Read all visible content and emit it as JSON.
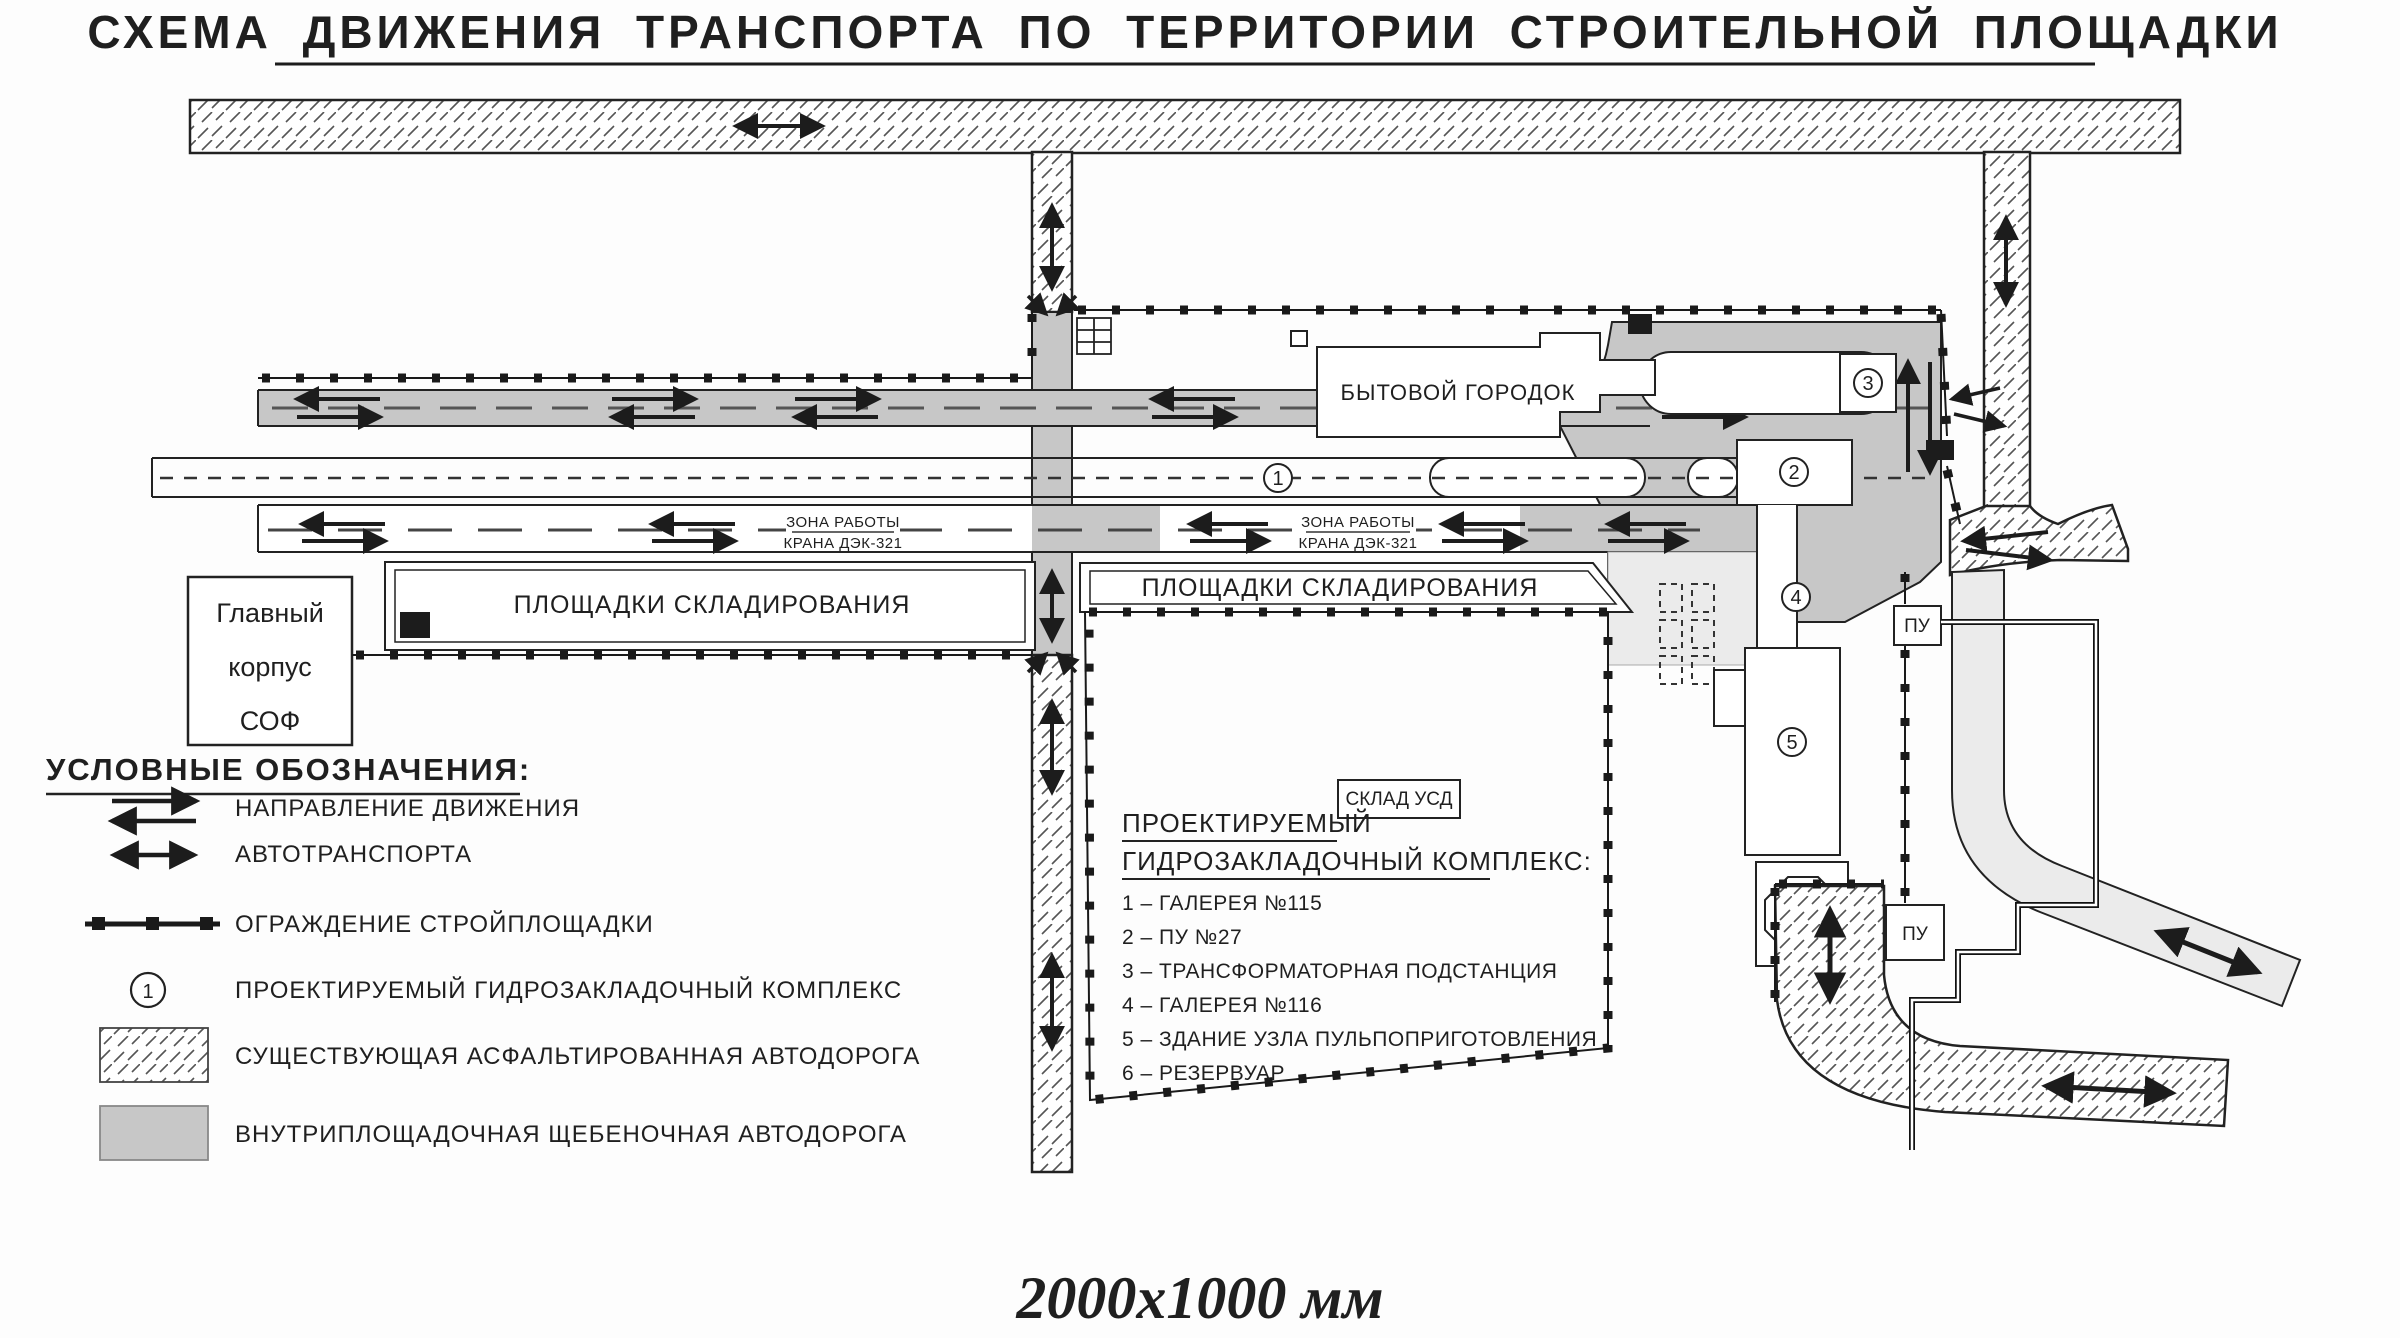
{
  "title": "СХЕМА ДВИЖЕНИЯ ТРАНСПОРТА ПО ТЕРРИТОРИИ СТРОИТЕЛЬНОЙ ПЛОЩАДКИ",
  "footer_size": "2000x1000 мм",
  "plan": {
    "main_building": {
      "line1": "Главный",
      "line2": "корпус",
      "line3": "СОФ"
    },
    "camp_label": "БЫТОВОЙ ГОРОДОК",
    "storage_area_1": "ПЛОЩАДКИ СКЛАДИРОВАНИЯ",
    "storage_area_2": "ПЛОЩАДКИ СКЛАДИРОВАНИЯ",
    "crane_zone": {
      "line1": "ЗОНА РАБОТЫ",
      "line2": "КРАНА ДЭК-321"
    },
    "usd_warehouse": "СКЛАД УСД",
    "pu_label_1": "ПУ",
    "pu_label_2": "ПУ",
    "markers": {
      "1": "1",
      "2": "2",
      "3": "3",
      "4": "4",
      "5": "5",
      "6": "6"
    }
  },
  "complex_list": {
    "heading_line1": "ПРОЕКТИРУЕМЫЙ",
    "heading_line2": "ГИДРОЗАКЛАДОЧНЫЙ КОМПЛЕКС:",
    "items": [
      "1 – ГАЛЕРЕЯ №115",
      "2 – ПУ №27",
      "3 – ТРАНСФОРМАТОРНАЯ ПОДСТАНЦИЯ",
      "4 – ГАЛЕРЕЯ №116",
      "5 – ЗДАНИЕ УЗЛА ПУЛЬПОПРИГОТОВЛЕНИЯ",
      "6 – РЕЗЕРВУАР"
    ]
  },
  "legend": {
    "heading": "УСЛОВНЫЕ ОБОЗНАЧЕНИЯ:",
    "direction_line1": "НАПРАВЛЕНИЕ ДВИЖЕНИЯ",
    "direction_line2": "АВТОТРАНСПОРТА",
    "fence": "ОГРАЖДЕНИЕ СТРОЙПЛОЩАДКИ",
    "complex_marker": "ПРОЕКТИРУЕМЫЙ ГИДРОЗАКЛАДОЧНЫЙ КОМПЛЕКС",
    "asphalt_road": "СУЩЕСТВУЮЩАЯ АСФАЛЬТИРОВАННАЯ АВТОДОРОГА",
    "gravel_road": "ВНУТРИПЛОЩАДОЧНАЯ ЩЕБЕНОЧНАЯ АВТОДОРОГА",
    "sample_marker": "1"
  },
  "colors": {
    "gravel_road": "#c7c7c7",
    "light_road": "#ebebeb",
    "line": "#1c1c1c"
  }
}
